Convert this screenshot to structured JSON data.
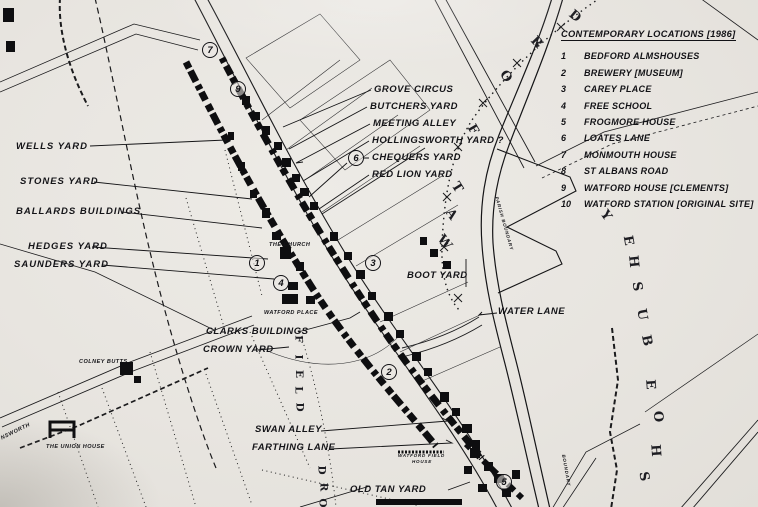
{
  "legend": {
    "title": "CONTEMPORARY LOCATIONS [1986]",
    "items": [
      {
        "num": "1",
        "label": "BEDFORD ALMSHOUSES"
      },
      {
        "num": "2",
        "label": "BREWERY [MUSEUM]"
      },
      {
        "num": "3",
        "label": "CAREY PLACE"
      },
      {
        "num": "4",
        "label": "FREE SCHOOL"
      },
      {
        "num": "5",
        "label": "FROGMORE HOUSE"
      },
      {
        "num": "6",
        "label": "LOATES LANE"
      },
      {
        "num": "7",
        "label": "MONMOUTH HOUSE"
      },
      {
        "num": "8",
        "label": "ST ALBANS ROAD"
      },
      {
        "num": "9",
        "label": "WATFORD HOUSE [CLEMENTS]"
      },
      {
        "num": "10",
        "label": "WATFORD STATION [ORIGINAL SITE]"
      }
    ]
  },
  "yard_labels": {
    "wells": "WELLS YARD",
    "stones": "STONES YARD",
    "ballards": "BALLARDS BUILDINGS",
    "hedges": "HEDGES YARD",
    "saunders": "SAUNDERS YARD",
    "grove": "GROVE CIRCUS",
    "butchers": "BUTCHERS YARD",
    "meeting": "MEETING ALLEY",
    "hollingsworth": "HOLLINGSWORTH YARD ?",
    "chequers": "CHEQUERS YARD",
    "redlion": "RED LION YARD",
    "boot": "BOOT YARD",
    "water": "WATER LANE",
    "clarks": "CLARKS BUILDINGS",
    "crown": "CROWN YARD",
    "swan": "SWAN ALLEY",
    "farthing": "FARTHING LANE",
    "oldtan": "OLD TAN YARD"
  },
  "map_labels": {
    "church": "THE CHURCH",
    "watford_place": "WATFORD PLACE",
    "colney_butts": "COLNEY BUTTS",
    "union_house": "THE UNION HOUSE",
    "watford_field": "WATFORD FIELD",
    "house": "HOUSE",
    "nsworth": "NSWORTH",
    "parish_boundary": "PARISH BOUNDARY",
    "boundary": "BOUNDARY"
  },
  "markers": [
    "7",
    "9",
    "6",
    "1",
    "4",
    "3",
    "2",
    "5"
  ],
  "letters": {
    "watford": [
      "W",
      "A",
      "T",
      "F",
      "O",
      "R",
      "D"
    ],
    "bushey": [
      "B",
      "U",
      "S",
      "H",
      "E",
      "Y"
    ],
    "shoe": [
      "S",
      "H",
      "O",
      "E"
    ],
    "field": [
      "F",
      "I",
      "E",
      "L",
      "D"
    ],
    "ord": [
      "O",
      "R",
      "D"
    ]
  },
  "colors": {
    "ink": "#141418",
    "paper": "#e8e5e0"
  }
}
